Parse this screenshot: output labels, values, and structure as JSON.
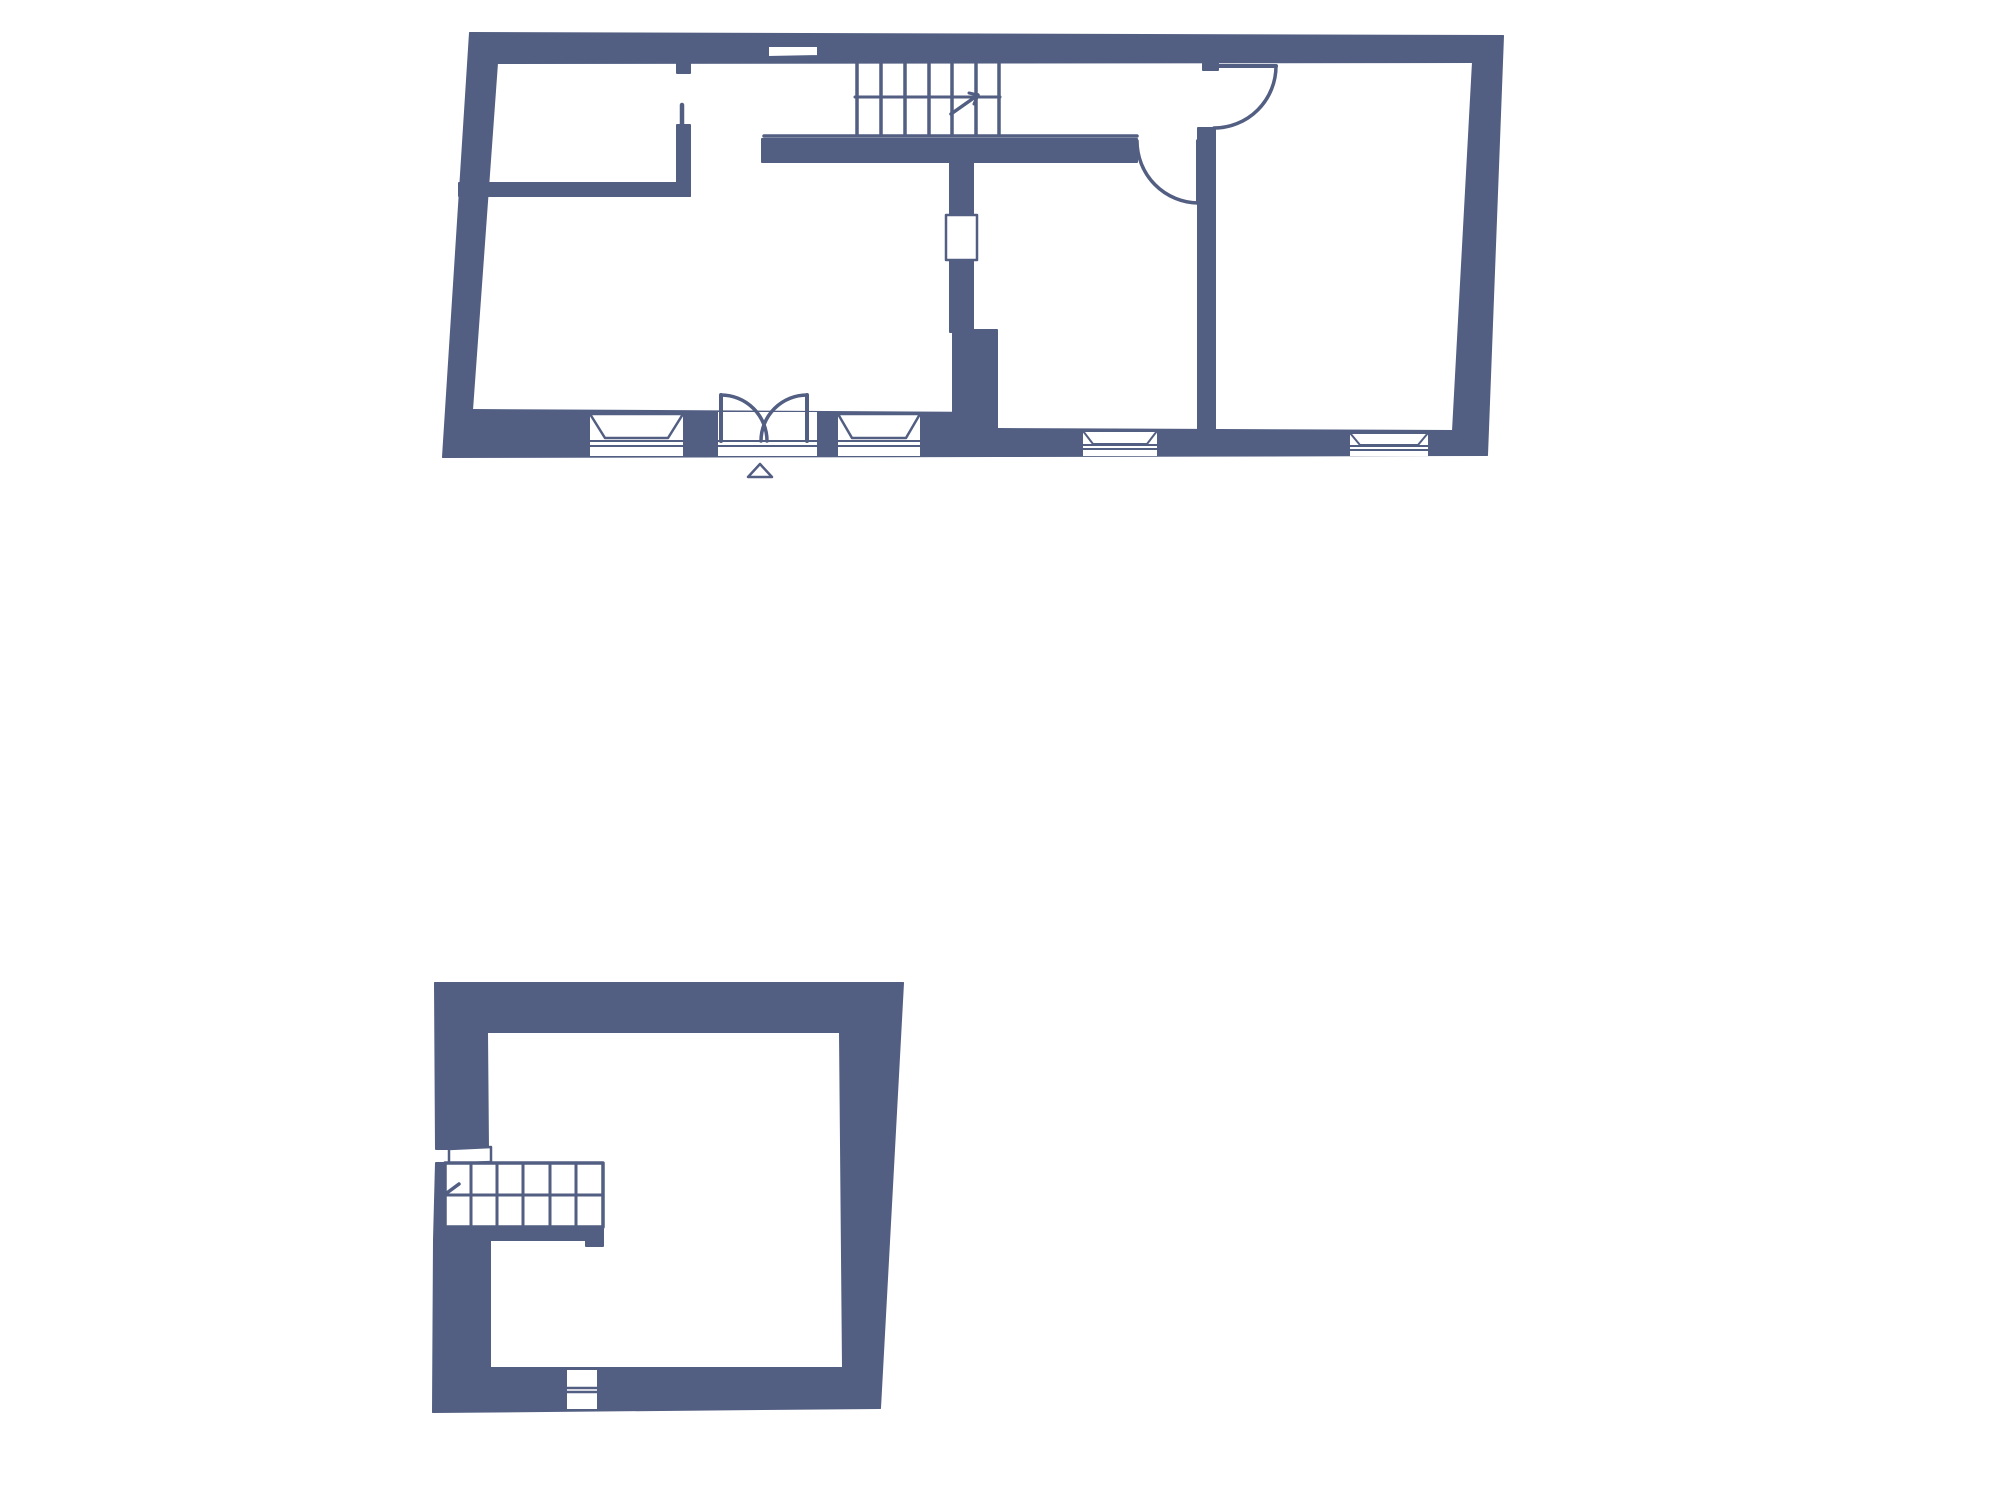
{
  "meta": {
    "canvas_width": 2000,
    "canvas_height": 1500,
    "background_color": "#ffffff",
    "wall_color": "#525e82",
    "line_color": "#525e82",
    "window_fill": "#ffffff"
  },
  "floors": [
    {
      "name": "ground-floor-plan",
      "walls": [
        {
          "n": "outer-wall-top",
          "pts": [
            [
              470,
              33
            ],
            [
              1503,
              36
            ],
            [
              1473,
              62
            ],
            [
              497,
              63
            ]
          ]
        },
        {
          "n": "outer-wall-right",
          "pts": [
            [
              1503,
              36
            ],
            [
              1487,
              455
            ],
            [
              1453,
              431
            ],
            [
              1473,
              62
            ]
          ]
        },
        {
          "n": "outer-wall-bottom-thick",
          "pts": [
            [
              472,
              410
            ],
            [
              997,
              413
            ],
            [
              997,
              456
            ],
            [
              443,
              457
            ]
          ]
        },
        {
          "n": "outer-wall-bottom-thin",
          "pts": [
            [
              997,
              429
            ],
            [
              1453,
              431
            ],
            [
              1487,
              455
            ],
            [
              997,
              456
            ]
          ]
        },
        {
          "n": "outer-wall-left",
          "pts": [
            [
              470,
              33
            ],
            [
              497,
              63
            ],
            [
              472,
              410
            ],
            [
              443,
              457
            ]
          ]
        },
        {
          "n": "interior-wall-room-horizontal",
          "pts": [
            [
              459,
              183
            ],
            [
              690,
              183
            ],
            [
              690,
              196
            ],
            [
              459,
              196
            ]
          ]
        },
        {
          "n": "interior-wall-pier",
          "pts": [
            [
              677,
              125
            ],
            [
              690,
              125
            ],
            [
              690,
              196
            ],
            [
              677,
              196
            ]
          ]
        },
        {
          "n": "interior-wall-stub-top",
          "pts": [
            [
              677,
              58
            ],
            [
              690,
              58
            ],
            [
              690,
              73
            ],
            [
              677,
              73
            ]
          ]
        },
        {
          "n": "interior-wall-under-stairs",
          "pts": [
            [
              762,
              139
            ],
            [
              1137,
              139
            ],
            [
              1137,
              162
            ],
            [
              762,
              162
            ]
          ]
        },
        {
          "n": "interior-wall-middle-upper",
          "pts": [
            [
              950,
              150
            ],
            [
              973,
              150
            ],
            [
              973,
              332
            ],
            [
              950,
              332
            ]
          ]
        },
        {
          "n": "interior-wall-middle-lower",
          "pts": [
            [
              953,
              330
            ],
            [
              997,
              330
            ],
            [
              997,
              414
            ],
            [
              953,
              414
            ]
          ]
        },
        {
          "n": "interior-wall-right-vertical",
          "pts": [
            [
              1198,
              128
            ],
            [
              1215,
              128
            ],
            [
              1215,
              431
            ],
            [
              1198,
              431
            ]
          ]
        },
        {
          "n": "interior-wall-right-stub",
          "pts": [
            [
              1203,
              57
            ],
            [
              1218,
              57
            ],
            [
              1218,
              70
            ],
            [
              1203,
              70
            ]
          ]
        }
      ],
      "whites": [
        {
          "n": "window-top-wall",
          "pts": [
            [
              768,
              46
            ],
            [
              818,
              46
            ],
            [
              818,
              56
            ],
            [
              768,
              57
            ]
          ],
          "s": 2
        },
        {
          "n": "window-middle-wall",
          "pts": [
            [
              946,
              215
            ],
            [
              977,
              215
            ],
            [
              977,
              260
            ],
            [
              946,
              260
            ]
          ],
          "s": 2.5
        },
        {
          "n": "window-cut-1",
          "pts": [
            [
              590,
              413
            ],
            [
              683,
              414
            ],
            [
              683,
              456
            ],
            [
              590,
              456
            ]
          ],
          "s": 0
        },
        {
          "n": "door-cut-entry",
          "pts": [
            [
              718,
              412
            ],
            [
              817,
              412
            ],
            [
              817,
              456
            ],
            [
              718,
              456
            ]
          ],
          "s": 0
        },
        {
          "n": "window-cut-2",
          "pts": [
            [
              838,
              413
            ],
            [
              920,
              413
            ],
            [
              920,
              456
            ],
            [
              838,
              456
            ]
          ],
          "s": 0
        },
        {
          "n": "window-cut-3",
          "pts": [
            [
              1083,
              430
            ],
            [
              1157,
              430
            ],
            [
              1157,
              456
            ],
            [
              1083,
              456
            ]
          ],
          "s": 0
        },
        {
          "n": "window-cut-4",
          "pts": [
            [
              1350,
              432
            ],
            [
              1428,
              432
            ],
            [
              1428,
              456
            ],
            [
              1350,
              456
            ]
          ],
          "s": 0
        },
        {
          "n": "window-sill-1",
          "pts": [
            [
              590,
              414
            ],
            [
              683,
              414
            ],
            [
              668,
              438
            ],
            [
              605,
              438
            ]
          ],
          "s": 2.5
        },
        {
          "n": "window-sill-2",
          "pts": [
            [
              838,
              414
            ],
            [
              920,
              414
            ],
            [
              906,
              438
            ],
            [
              852,
              438
            ]
          ],
          "s": 2.5
        },
        {
          "n": "window-sill-3",
          "pts": [
            [
              1083,
              431
            ],
            [
              1157,
              431
            ],
            [
              1147,
              444
            ],
            [
              1093,
              444
            ]
          ],
          "s": 2
        },
        {
          "n": "window-sill-4",
          "pts": [
            [
              1350,
              433
            ],
            [
              1428,
              433
            ],
            [
              1418,
              445
            ],
            [
              1360,
              445
            ]
          ],
          "s": 2
        },
        {
          "n": "entrance-marker-triangle",
          "pts": [
            [
              748,
              477
            ],
            [
              772,
              477
            ],
            [
              760,
              464
            ]
          ],
          "s": 2.5
        }
      ],
      "lines": [
        {
          "n": "window-line",
          "x1": 590,
          "y1": 441,
          "x2": 683,
          "y2": 441,
          "w": 2
        },
        {
          "n": "window-line",
          "x1": 590,
          "y1": 446,
          "x2": 683,
          "y2": 446,
          "w": 2
        },
        {
          "n": "door-threshold-line",
          "x1": 718,
          "y1": 441,
          "x2": 817,
          "y2": 441,
          "w": 2
        },
        {
          "n": "door-threshold-line",
          "x1": 718,
          "y1": 446,
          "x2": 817,
          "y2": 446,
          "w": 2
        },
        {
          "n": "window-line",
          "x1": 838,
          "y1": 441,
          "x2": 920,
          "y2": 441,
          "w": 2
        },
        {
          "n": "window-line",
          "x1": 838,
          "y1": 446,
          "x2": 920,
          "y2": 446,
          "w": 2
        },
        {
          "n": "window-line",
          "x1": 1083,
          "y1": 445,
          "x2": 1157,
          "y2": 445,
          "w": 2
        },
        {
          "n": "window-line",
          "x1": 1083,
          "y1": 449,
          "x2": 1157,
          "y2": 449,
          "w": 2
        },
        {
          "n": "window-line",
          "x1": 1350,
          "y1": 446,
          "x2": 1428,
          "y2": 446,
          "w": 2
        },
        {
          "n": "window-line",
          "x1": 1350,
          "y1": 450,
          "x2": 1428,
          "y2": 450,
          "w": 2
        },
        {
          "n": "stair-tread",
          "x1": 857,
          "y1": 58,
          "x2": 857,
          "y2": 135,
          "w": 3.5
        },
        {
          "n": "stair-tread",
          "x1": 881,
          "y1": 58,
          "x2": 881,
          "y2": 135,
          "w": 3.5
        },
        {
          "n": "stair-tread",
          "x1": 905,
          "y1": 58,
          "x2": 905,
          "y2": 135,
          "w": 3.5
        },
        {
          "n": "stair-tread",
          "x1": 929,
          "y1": 58,
          "x2": 929,
          "y2": 135,
          "w": 3.5
        },
        {
          "n": "stair-tread",
          "x1": 952,
          "y1": 58,
          "x2": 952,
          "y2": 135,
          "w": 3.5
        },
        {
          "n": "stair-tread",
          "x1": 976,
          "y1": 58,
          "x2": 976,
          "y2": 135,
          "w": 3.5
        },
        {
          "n": "stair-tread",
          "x1": 999,
          "y1": 58,
          "x2": 999,
          "y2": 135,
          "w": 3.5
        },
        {
          "n": "stair-mid-line",
          "x1": 855,
          "y1": 97,
          "x2": 1000,
          "y2": 97,
          "w": 3
        },
        {
          "n": "stair-bottom-line",
          "x1": 764,
          "y1": 136,
          "x2": 1137,
          "y2": 136,
          "w": 3.5
        },
        {
          "n": "stair-direction-arrow",
          "x1": 951,
          "y1": 114,
          "x2": 978,
          "y2": 95,
          "w": 3.5
        },
        {
          "n": "stair-arrow-barb",
          "x1": 978,
          "y1": 95,
          "x2": 969,
          "y2": 93,
          "w": 3
        },
        {
          "n": "stair-arrow-barb",
          "x1": 978,
          "y1": 95,
          "x2": 974,
          "y2": 104,
          "w": 3
        },
        {
          "n": "doorway-pier-line",
          "x1": 682,
          "y1": 105,
          "x2": 682,
          "y2": 126,
          "w": 4.5
        },
        {
          "n": "door-leaf",
          "x1": 1214,
          "y1": 66,
          "x2": 1276,
          "y2": 66,
          "w": 4
        },
        {
          "n": "door-leaf",
          "x1": 1198,
          "y1": 141,
          "x2": 1198,
          "y2": 203,
          "w": 4
        },
        {
          "n": "double-door-leaf",
          "x1": 721,
          "y1": 395,
          "x2": 721,
          "y2": 441,
          "w": 4
        },
        {
          "n": "double-door-leaf",
          "x1": 807,
          "y1": 395,
          "x2": 807,
          "y2": 441,
          "w": 4
        }
      ],
      "arcs": [
        {
          "n": "door-swing-arc",
          "x1": 1276,
          "y1": 66,
          "x2": 1214,
          "y2": 128,
          "r": 62,
          "sweep": 1,
          "w": 3.5
        },
        {
          "n": "door-swing-arc",
          "x1": 1137,
          "y1": 141,
          "x2": 1198,
          "y2": 203,
          "r": 62,
          "sweep": 0,
          "w": 3.5
        },
        {
          "n": "double-door-swing-arc",
          "x1": 721,
          "y1": 395,
          "x2": 767,
          "y2": 441,
          "r": 46,
          "sweep": 1,
          "w": 3.5
        },
        {
          "n": "double-door-swing-arc",
          "x1": 807,
          "y1": 395,
          "x2": 761,
          "y2": 441,
          "r": 46,
          "sweep": 0,
          "w": 3.5
        }
      ]
    },
    {
      "name": "first-floor-plan",
      "walls": [
        {
          "n": "outer-wall-top",
          "pts": [
            [
              435,
              983
            ],
            [
              903,
              983
            ],
            [
              840,
              1032
            ],
            [
              487,
              1032
            ]
          ]
        },
        {
          "n": "outer-wall-right",
          "pts": [
            [
              903,
              983
            ],
            [
              880,
              1408
            ],
            [
              843,
              1368
            ],
            [
              840,
              1032
            ]
          ]
        },
        {
          "n": "outer-wall-bottom",
          "pts": [
            [
              490,
              1368
            ],
            [
              843,
              1368
            ],
            [
              880,
              1408
            ],
            [
              433,
              1412
            ]
          ]
        },
        {
          "n": "outer-wall-left-upper",
          "pts": [
            [
              435,
              983
            ],
            [
              487,
              1032
            ],
            [
              488,
              1149
            ],
            [
              436,
              1149
            ]
          ]
        },
        {
          "n": "outer-wall-left-mid",
          "pts": [
            [
              436,
              1163
            ],
            [
              488,
              1163
            ],
            [
              489,
              1240
            ],
            [
              434,
              1240
            ]
          ]
        },
        {
          "n": "outer-wall-left-lower",
          "pts": [
            [
              434,
              1240
            ],
            [
              490,
              1240
            ],
            [
              490,
              1368
            ],
            [
              433,
              1412
            ]
          ]
        },
        {
          "n": "stair-base-bar",
          "pts": [
            [
              445,
              1227
            ],
            [
              603,
              1227
            ],
            [
              603,
              1240
            ],
            [
              445,
              1240
            ]
          ]
        },
        {
          "n": "stair-base-step",
          "pts": [
            [
              586,
              1240
            ],
            [
              603,
              1240
            ],
            [
              603,
              1246
            ],
            [
              586,
              1246
            ]
          ]
        }
      ],
      "whites": [
        {
          "n": "stair-landing-slot",
          "pts": [
            [
              449,
              1149
            ],
            [
              491,
              1147
            ],
            [
              491,
              1162
            ],
            [
              449,
              1164
            ]
          ],
          "s": 2.5
        },
        {
          "n": "staircase-outline",
          "pts": [
            [
              445,
              1163
            ],
            [
              603,
              1163
            ],
            [
              603,
              1227
            ],
            [
              445,
              1227
            ]
          ],
          "s": 3.5
        },
        {
          "n": "window-bottom-wall",
          "pts": [
            [
              566,
              1369
            ],
            [
              598,
              1369
            ],
            [
              598,
              1410
            ],
            [
              566,
              1410
            ]
          ],
          "s": 2
        }
      ],
      "lines": [
        {
          "n": "stair-tread",
          "x1": 471,
          "y1": 1163,
          "x2": 471,
          "y2": 1227,
          "w": 3
        },
        {
          "n": "stair-tread",
          "x1": 497,
          "y1": 1163,
          "x2": 497,
          "y2": 1227,
          "w": 3
        },
        {
          "n": "stair-tread",
          "x1": 523,
          "y1": 1163,
          "x2": 523,
          "y2": 1227,
          "w": 3
        },
        {
          "n": "stair-tread",
          "x1": 550,
          "y1": 1163,
          "x2": 550,
          "y2": 1227,
          "w": 3
        },
        {
          "n": "stair-tread",
          "x1": 576,
          "y1": 1163,
          "x2": 576,
          "y2": 1227,
          "w": 3
        },
        {
          "n": "stair-mid-line",
          "x1": 445,
          "y1": 1195,
          "x2": 603,
          "y2": 1195,
          "w": 3
        },
        {
          "n": "stair-direction-arrow",
          "x1": 440,
          "y1": 1198,
          "x2": 459,
          "y2": 1184,
          "w": 3.5
        },
        {
          "n": "window-line",
          "x1": 566,
          "y1": 1388,
          "x2": 598,
          "y2": 1388,
          "w": 2.5
        },
        {
          "n": "window-line",
          "x1": 566,
          "y1": 1392,
          "x2": 598,
          "y2": 1392,
          "w": 2.5
        }
      ],
      "arcs": []
    }
  ]
}
